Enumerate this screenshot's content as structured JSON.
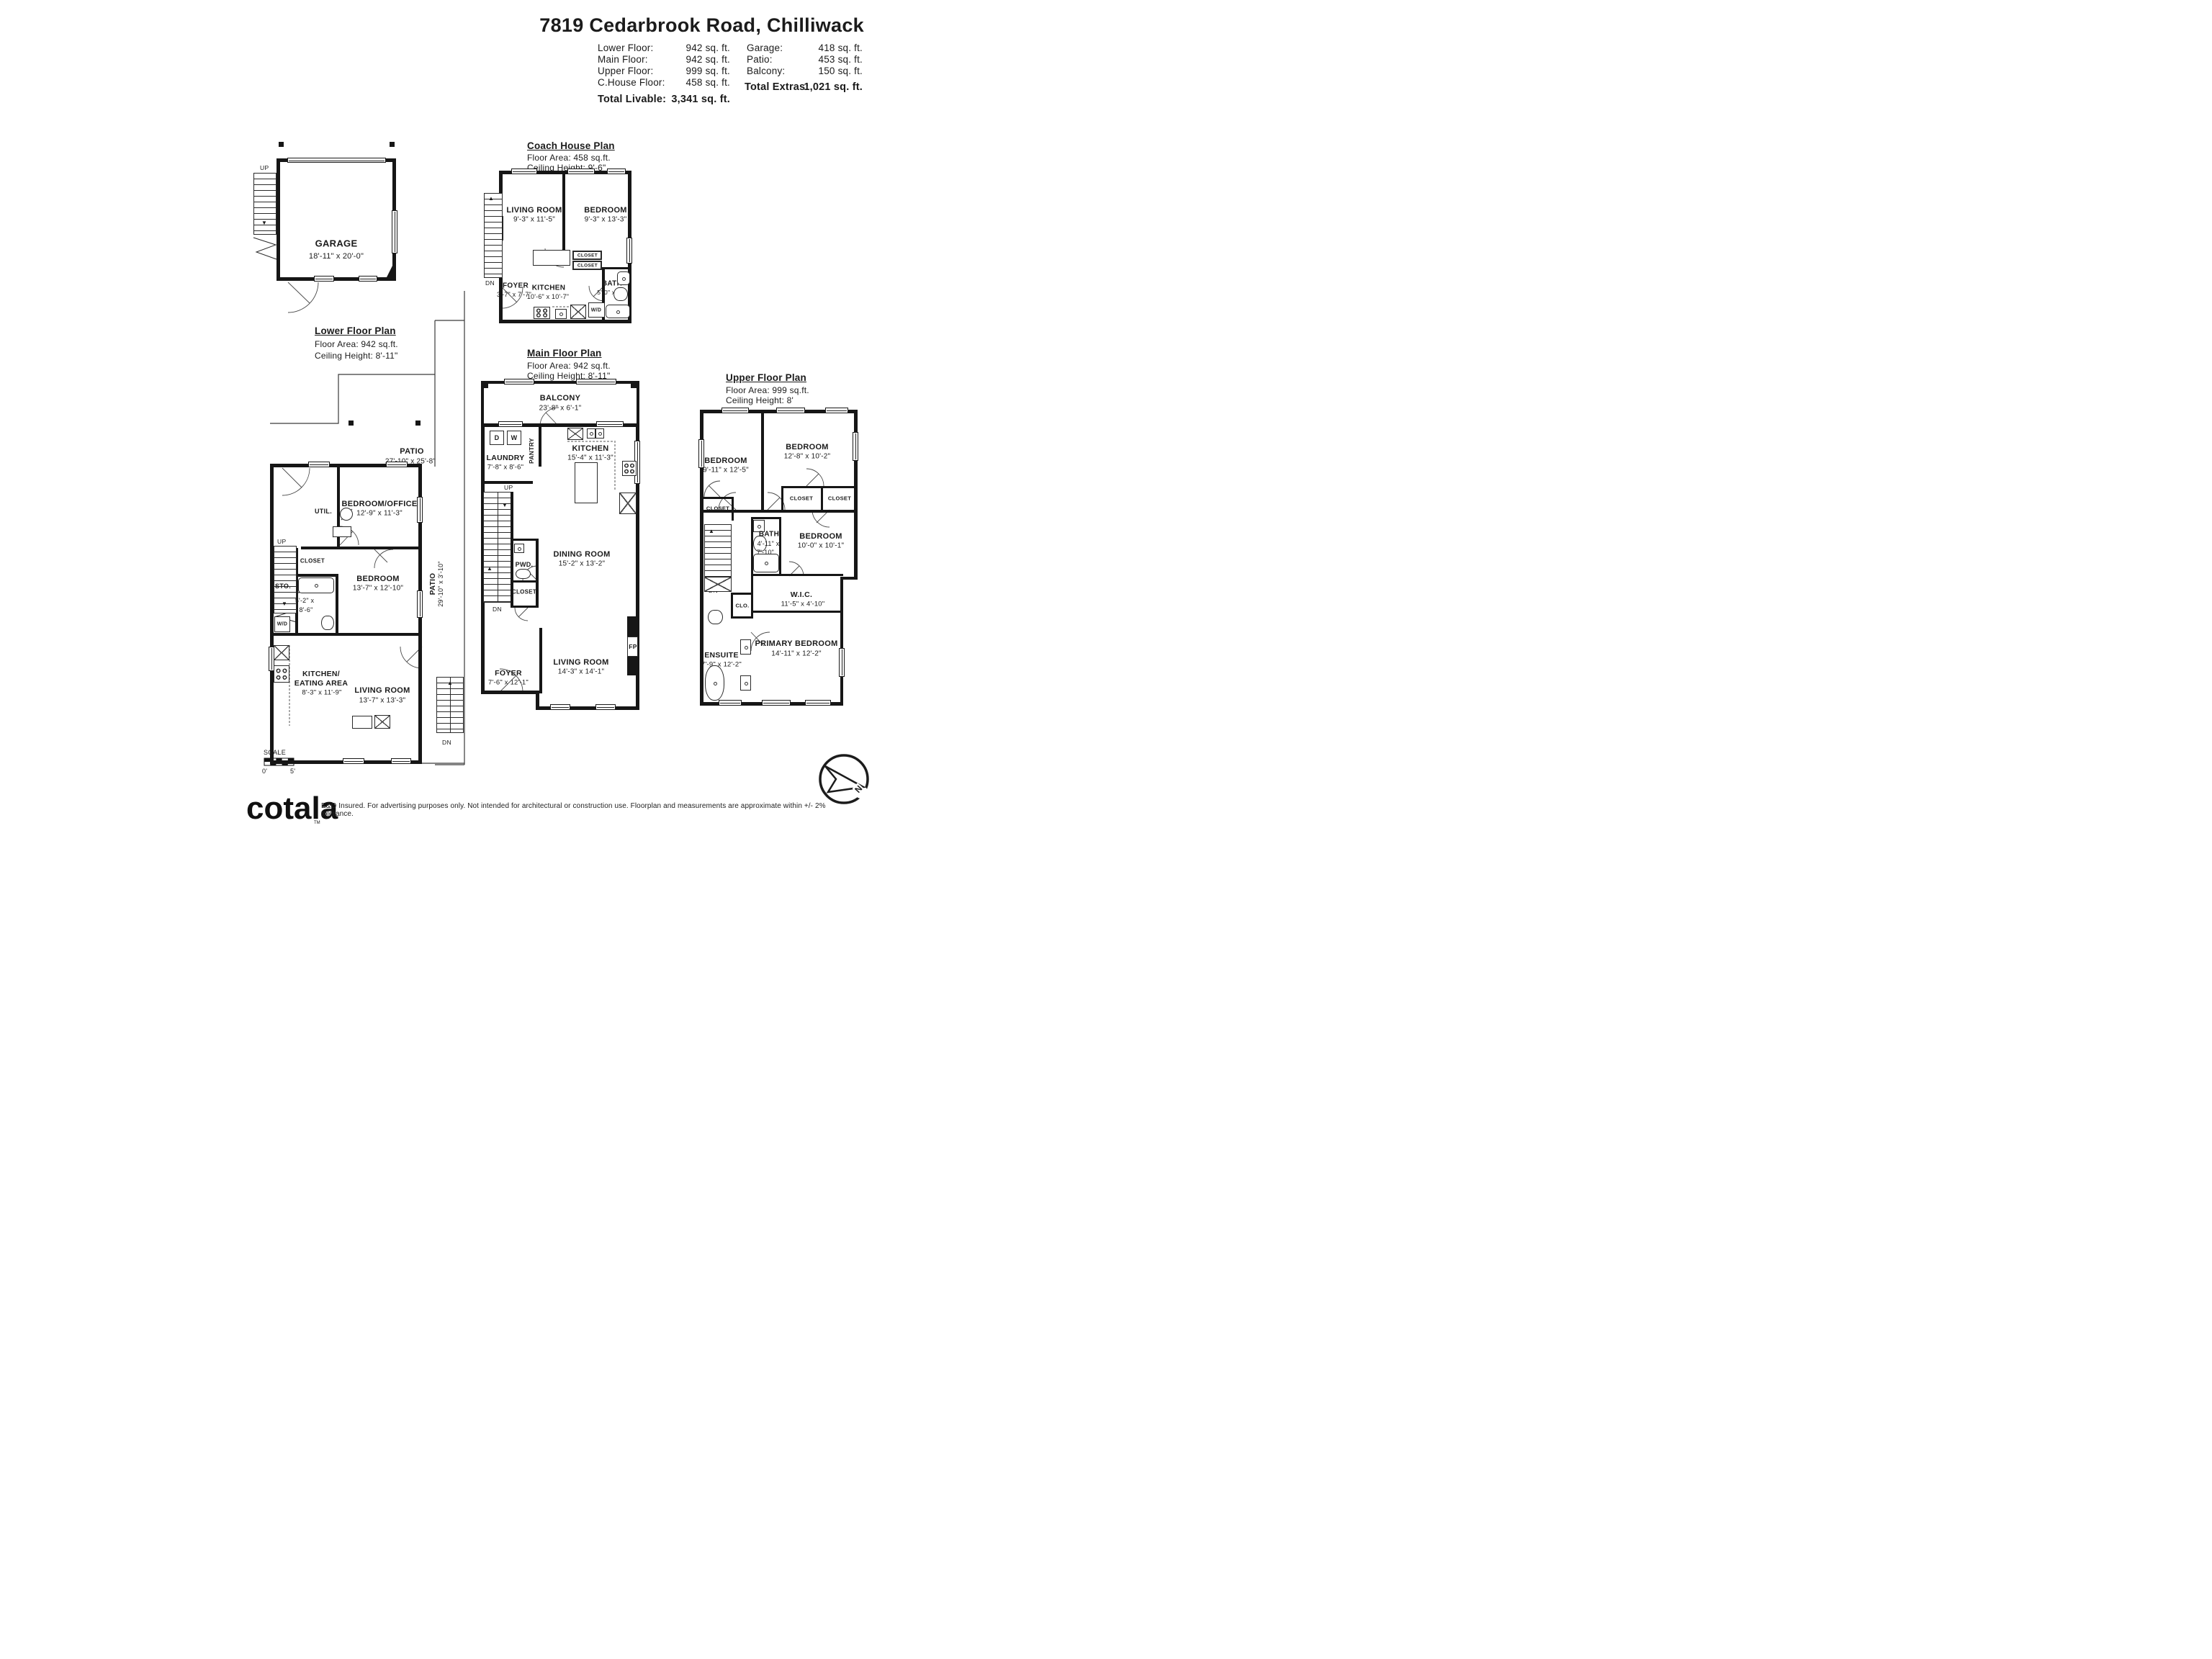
{
  "header": {
    "title": "7819 Cedarbrook Road, Chilliwack",
    "stats_left": [
      {
        "label": "Lower Floor:",
        "value": "942 sq. ft."
      },
      {
        "label": "Main Floor:",
        "value": "942 sq. ft."
      },
      {
        "label": "Upper Floor:",
        "value": "999 sq. ft."
      },
      {
        "label": "C.House Floor:",
        "value": "458 sq. ft."
      }
    ],
    "total_livable": {
      "label": "Total Livable:",
      "value": "3,341 sq. ft."
    },
    "stats_right": [
      {
        "label": "Garage:",
        "value": "418 sq. ft."
      },
      {
        "label": "Patio:",
        "value": "453 sq. ft."
      },
      {
        "label": "Balcony:",
        "value": "150 sq. ft."
      }
    ],
    "total_extras": {
      "label": "Total Extras:",
      "value": "1,021 sq. ft."
    }
  },
  "labels": {
    "up": "UP",
    "dn": "DN",
    "closet": "CLOSET",
    "wd": "W/D"
  },
  "plans": {
    "lower": {
      "title": "Lower Floor Plan",
      "area": "Floor Area: 942 sq.ft.",
      "ceiling": "Ceiling Height: 8'-11\"",
      "garage": {
        "name": "GARAGE",
        "dims": "18'-11\" x 20'-0\""
      },
      "patio": {
        "name": "PATIO",
        "dims": "27'-10\" x 25'-8\""
      },
      "patio_side": {
        "name": "PATIO",
        "dims": "29'-10\" x 3'-10\""
      },
      "bedroom_office": {
        "name": "BEDROOM/OFFICE",
        "dims": "12'-9\" x 11'-3\""
      },
      "util": "UTIL.",
      "sto": "STO.",
      "bath": {
        "name": "BATH",
        "dims_line1": "5'-2\" x",
        "dims_line2": "8'-6\""
      },
      "bedroom": {
        "name": "BEDROOM",
        "dims": "13'-7\" x 12'-10\""
      },
      "kitchen": {
        "name_line1": "KITCHEN/",
        "name_line2": "EATING AREA",
        "dims": "8'-3\" x 11'-9\""
      },
      "living": {
        "name": "LIVING ROOM",
        "dims": "13'-7\" x 13'-3\""
      }
    },
    "coach": {
      "title": "Coach House Plan",
      "area": "Floor Area: 458 sq.ft.",
      "ceiling": "Ceiling Height: 9'-6\"",
      "living": {
        "name": "LIVING ROOM",
        "dims": "9'-3\" x 11'-5\""
      },
      "bedroom": {
        "name": "BEDROOM",
        "dims": "9'-3\" x 13'-3\""
      },
      "foyer": {
        "name": "FOYER",
        "dims": "3'-7\" x 7'-7\""
      },
      "kitchen": {
        "name": "KITCHEN",
        "dims": "10'-6\" x 10'-7\""
      },
      "bath": {
        "name": "BATH",
        "dims": "5'-0\" x 8'-4\""
      }
    },
    "main": {
      "title": "Main Floor Plan",
      "area": "Floor Area: 942 sq.ft.",
      "ceiling": "Ceiling Height: 8'-11\"",
      "balcony": {
        "name": "BALCONY",
        "dims": "23'-8\" x 6'-1\""
      },
      "laundry": {
        "name": "LAUNDRY",
        "dims": "7'-8\" x 8'-6\""
      },
      "pantry": "PANTRY",
      "d": "D",
      "w": "W",
      "kitchen": {
        "name": "KITCHEN",
        "dims": "15'-4\" x 11'-3\""
      },
      "dining": {
        "name": "DINING ROOM",
        "dims": "15'-2\" x 13'-2\""
      },
      "pwd": "PWD.",
      "foyer": {
        "name": "FOYER",
        "dims": "7'-6\" x 12'-1\""
      },
      "living": {
        "name": "LIVING ROOM",
        "dims": "14'-3\" x 14'-1\""
      },
      "fp": "FP"
    },
    "upper": {
      "title": "Upper Floor Plan",
      "area": "Floor Area: 999 sq.ft.",
      "ceiling": "Ceiling Height: 8'",
      "bedroom1": {
        "name": "BEDROOM",
        "dims": "9'-11\" x 12'-5\""
      },
      "bedroom2": {
        "name": "BEDROOM",
        "dims": "12'-8\" x 10'-2\""
      },
      "bedroom3": {
        "name": "BEDROOM",
        "dims": "10'-0\" x 10'-1\""
      },
      "bath": {
        "name": "BATH",
        "dims_line1": "4'-11\" x",
        "dims_line2": "7'-10\""
      },
      "wic": {
        "name": "W.I.C.",
        "dims": "11'-5\" x 4'-10\""
      },
      "clo": "CLO.",
      "ensuite": {
        "name": "ENSUITE",
        "dims": "7'-9\" x 12'-2\""
      },
      "primary": {
        "name": "PRIMARY BEDROOM",
        "dims": "14'-11\" x 12'-2\""
      }
    }
  },
  "scale": {
    "label": "SCALE",
    "start": "0'",
    "end": "5'"
  },
  "compass": {
    "north": "N"
  },
  "footer": {
    "brand": "cotala",
    "tm": "TM",
    "disclaimer": "E&O Insured. For advertising purposes only. Not intended for architectural or construction use. Floorplan and measurements are approximate within +/- 2% tolerance."
  }
}
